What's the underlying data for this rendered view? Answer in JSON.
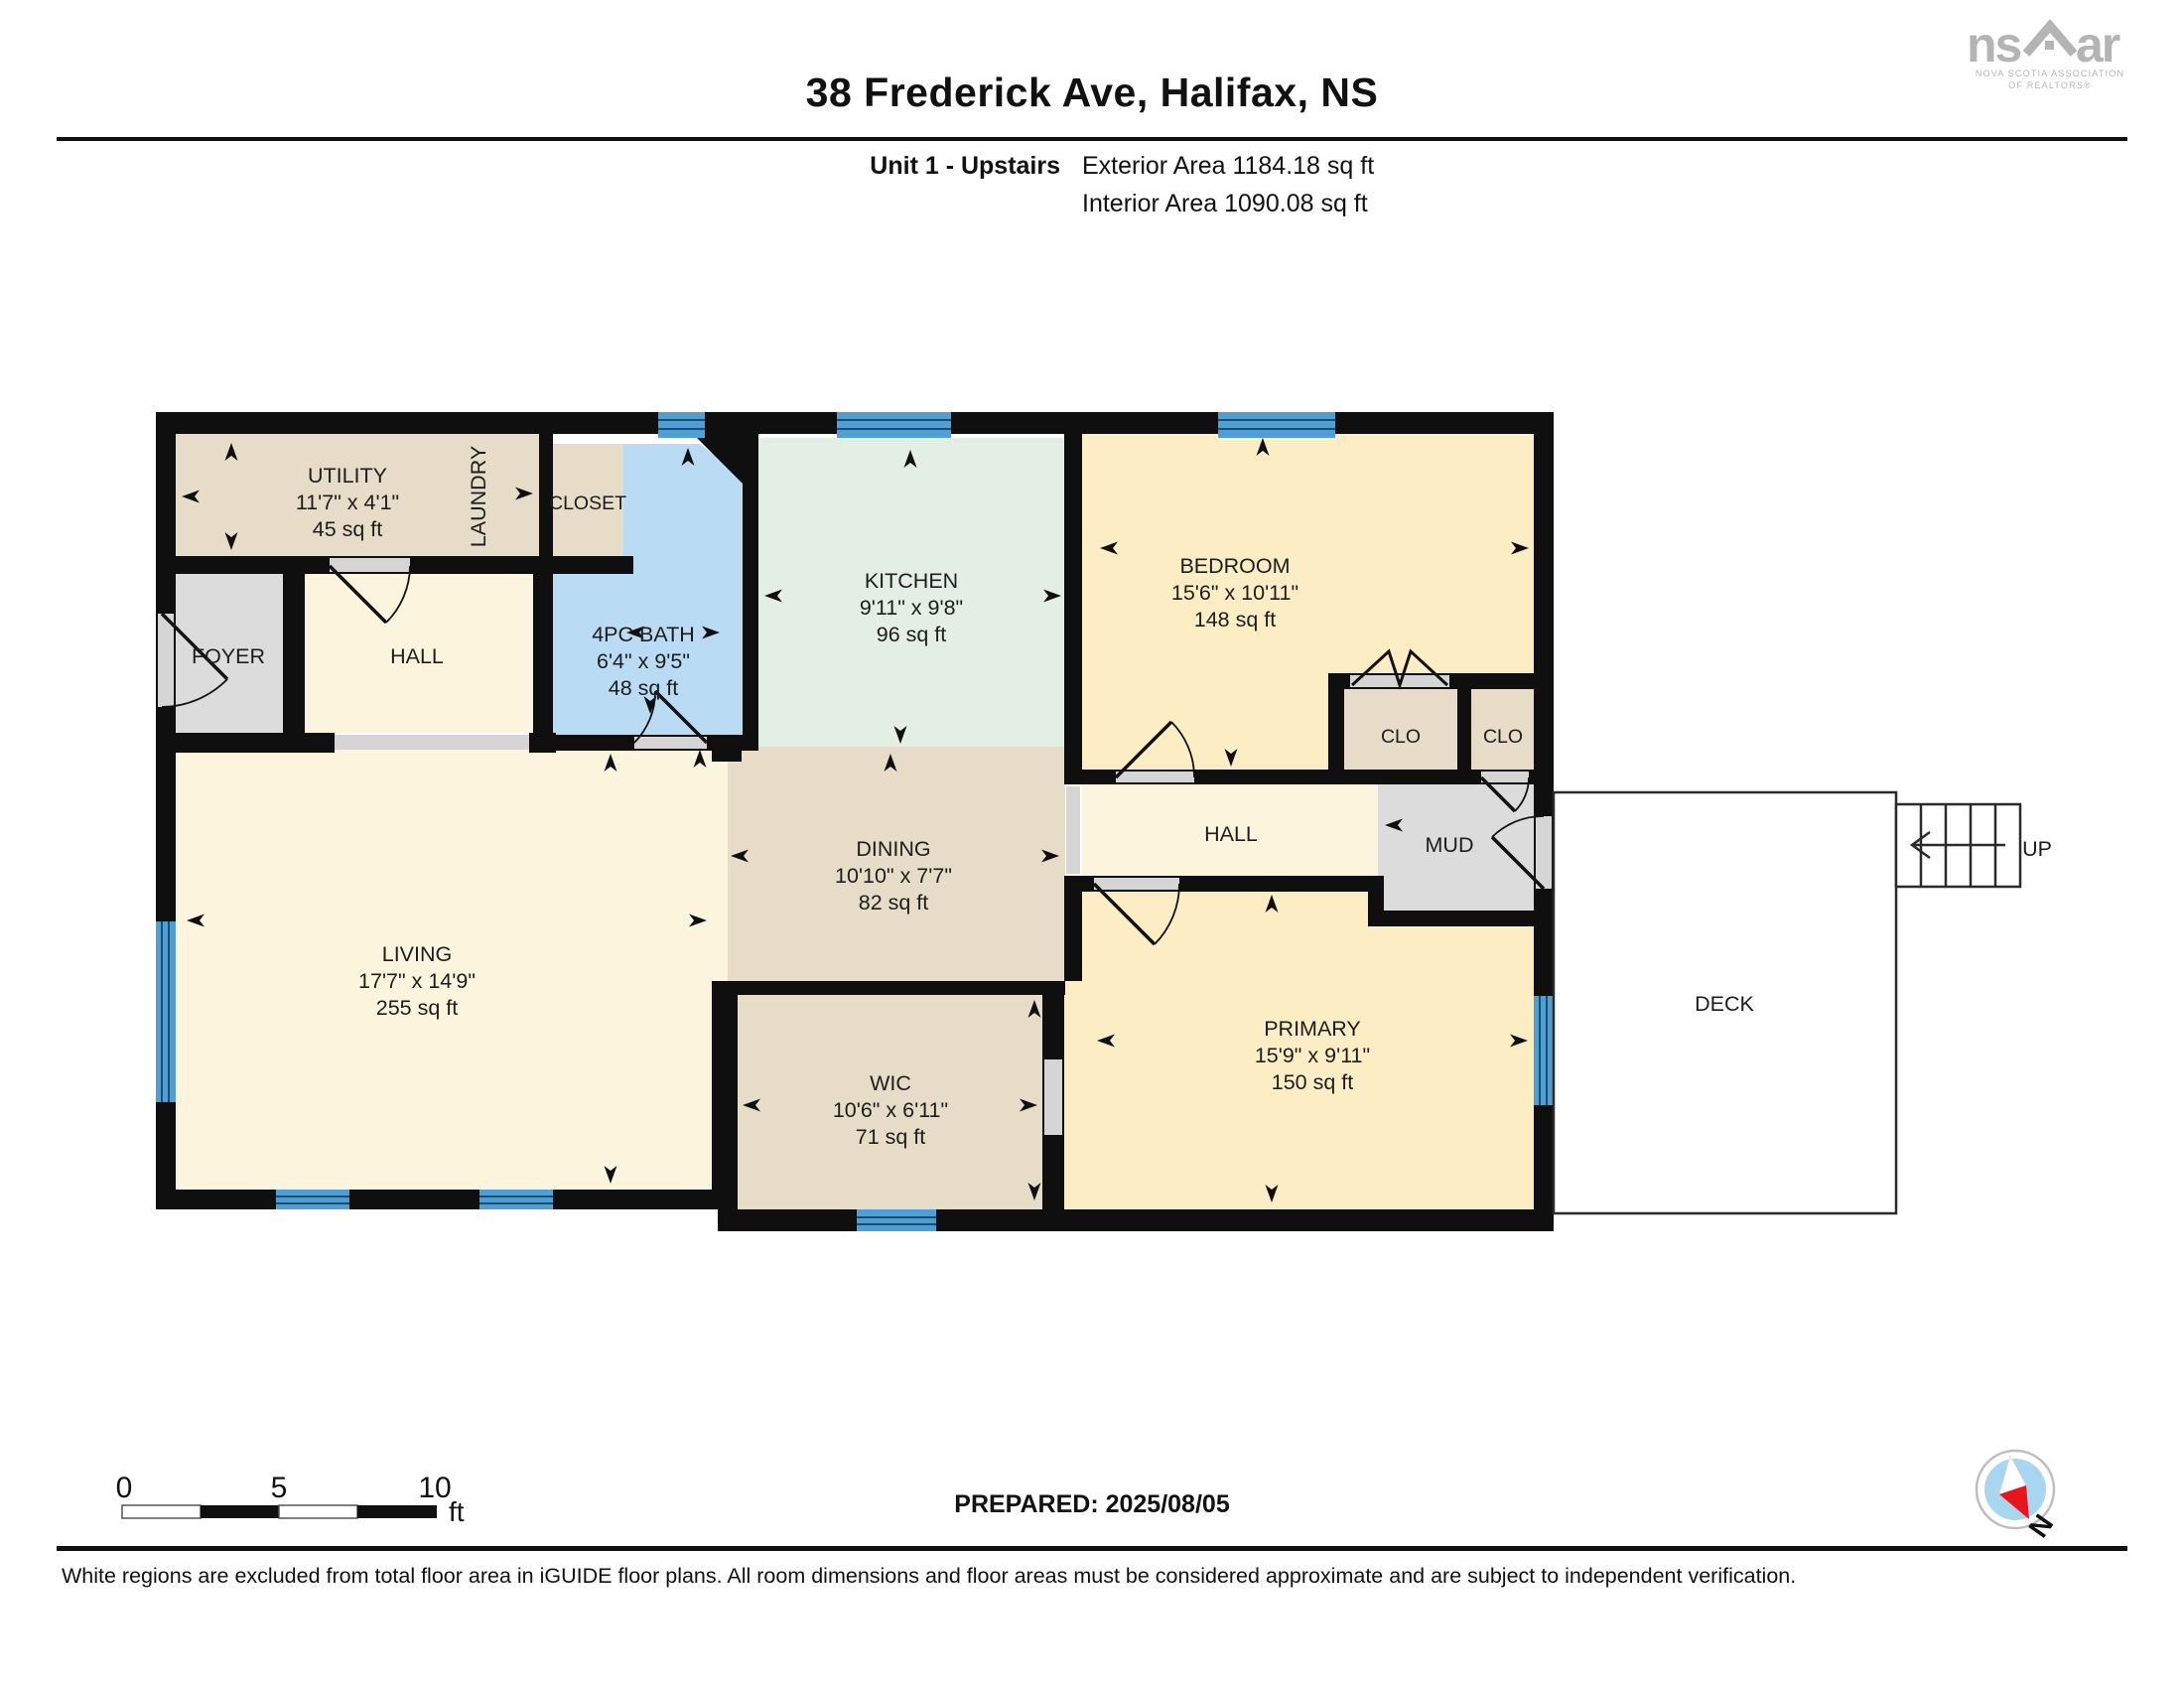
{
  "header": {
    "title": "38 Frederick Ave, Halifax, NS",
    "unit": "Unit 1 - Upstairs",
    "exterior_area": "Exterior Area 1184.18 sq ft",
    "interior_area": "Interior Area 1090.08 sq ft"
  },
  "brand": {
    "left": "ns",
    "right": "ar",
    "sub1": "NOVA SCOTIA ASSOCIATION",
    "sub2": "OF REALTORS®"
  },
  "rooms": {
    "utility": {
      "name": "UTILITY",
      "dims": "11'7\" x 4'1\"",
      "area": "45 sq ft"
    },
    "laundry": {
      "name": "LAUNDRY"
    },
    "closet": {
      "name": "CLOSET"
    },
    "bath": {
      "name": "4PC BATH",
      "dims": "6'4\" x 9'5\"",
      "area": "48 sq ft"
    },
    "kitchen": {
      "name": "KITCHEN",
      "dims": "9'11\" x 9'8\"",
      "area": "96 sq ft"
    },
    "bedroom": {
      "name": "BEDROOM",
      "dims": "15'6\" x 10'11\"",
      "area": "148 sq ft"
    },
    "foyer": {
      "name": "FOYER"
    },
    "hall_west": {
      "name": "HALL"
    },
    "hall_east": {
      "name": "HALL"
    },
    "clo_left": {
      "name": "CLO"
    },
    "clo_right": {
      "name": "CLO"
    },
    "mud": {
      "name": "MUD"
    },
    "dining": {
      "name": "DINING",
      "dims": "10'10\" x 7'7\"",
      "area": "82 sq ft"
    },
    "living": {
      "name": "LIVING",
      "dims": "17'7\" x 14'9\"",
      "area": "255 sq ft"
    },
    "wic": {
      "name": "WIC",
      "dims": "10'6\" x 6'11\"",
      "area": "71 sq ft"
    },
    "primary": {
      "name": "PRIMARY",
      "dims": "15'9\" x 9'11\"",
      "area": "150 sq ft"
    },
    "deck": {
      "name": "DECK"
    }
  },
  "stairs": {
    "label": "UP"
  },
  "scale_bar": {
    "t0": "0",
    "t5": "5",
    "t10": "10",
    "unit": "ft"
  },
  "compass": {
    "north": "N"
  },
  "footer": {
    "prepared": "PREPARED: 2025/08/05",
    "disclaimer": "White regions are excluded from total floor area in iGUIDE floor plans. All room dimensions and floor areas must be considered approximate and are subject to independent verification."
  },
  "colors": {
    "room_tan": "#e6dcc8",
    "room_cream": "#fcf4dd",
    "room_yellow": "#fcedc4",
    "room_mint": "#e3efe5",
    "room_blue": "#b9dcf4",
    "room_gray": "#dcdcdc",
    "wall": "#0f0f0f",
    "window_blue": "#4d9fd6",
    "opening_gray": "#d5d5d5"
  }
}
